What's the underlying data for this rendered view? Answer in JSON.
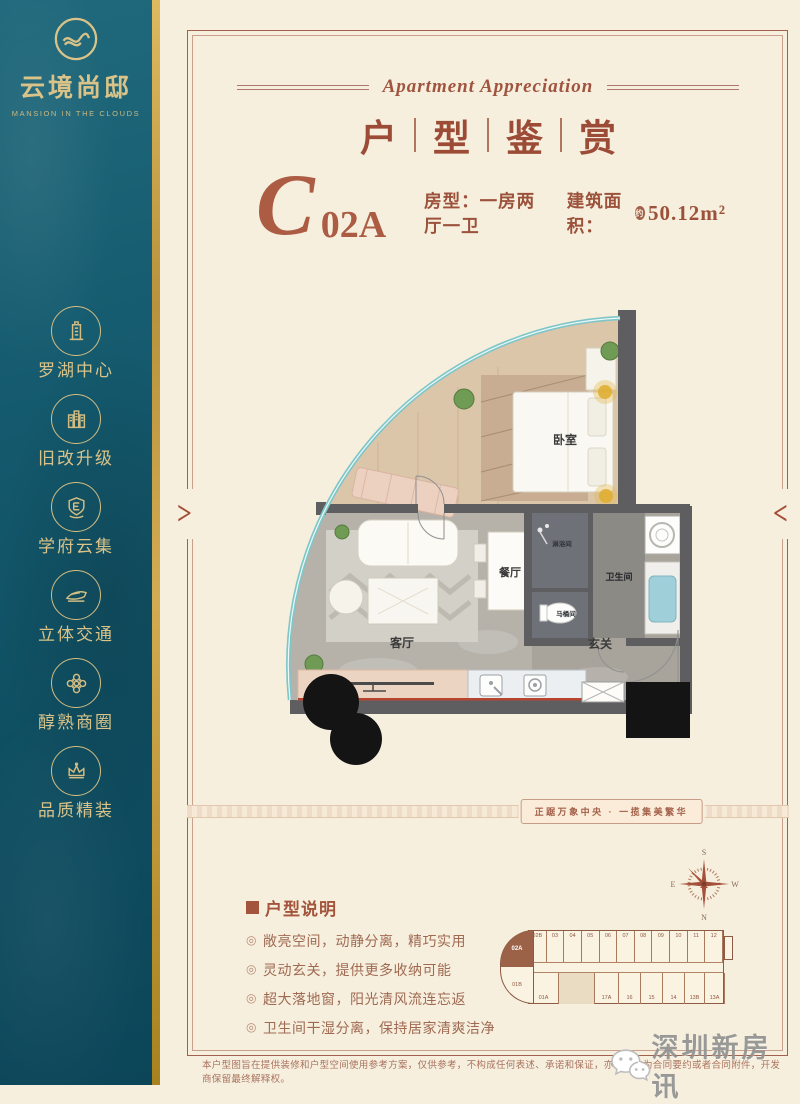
{
  "sidebar": {
    "logo": {
      "name": "云境尚邸",
      "subtitle": "MANSION IN THE CLOUDS"
    },
    "items": [
      {
        "icon": "tower-icon",
        "label": "罗湖中心"
      },
      {
        "icon": "buildings-icon",
        "label": "旧改升级"
      },
      {
        "icon": "shield-e-icon",
        "label": "学府云集"
      },
      {
        "icon": "train-icon",
        "label": "立体交通"
      },
      {
        "icon": "flower-icon",
        "label": "醇熟商圈"
      },
      {
        "icon": "crown-icon",
        "label": "品质精装"
      }
    ]
  },
  "header": {
    "script_title": "Apartment Appreciation",
    "title_chars": [
      "户",
      "型",
      "鉴",
      "赏"
    ]
  },
  "unit": {
    "letter": "C",
    "number": "02A",
    "layout_label": "房型：一房两厅一卫",
    "area_label": "建筑面积：",
    "area_approx": "约",
    "area_value": "50.12",
    "area_unit": "m²"
  },
  "plan": {
    "rooms": [
      {
        "label": "卧室"
      },
      {
        "label": "餐厅"
      },
      {
        "label": "客厅"
      },
      {
        "label": "玄关"
      },
      {
        "label": "淋浴间"
      },
      {
        "label": "马桶间"
      },
      {
        "label": "卫生间"
      }
    ]
  },
  "band": {
    "slogan": "正踞万象中央 · 一揽集美繁华"
  },
  "notes": {
    "title": "户型说明",
    "bullet": "◎",
    "items": [
      "敞亮空间，动静分离，精巧实用",
      "灵动玄关，提供更多收纳可能",
      "超大落地窗，阳光清风流连忘返",
      "卫生间干湿分离，保持居家清爽洁净"
    ]
  },
  "compass": {
    "top": "S",
    "left": "E",
    "right": "W",
    "bottom": "N"
  },
  "keyplan": {
    "highlight": "02A",
    "top": [
      "02B",
      "03",
      "04",
      "05",
      "06",
      "07",
      "08",
      "09",
      "10",
      "11",
      "12"
    ],
    "bottom_left": [
      "01B",
      "01A"
    ],
    "bottom_right": [
      "17A",
      "16",
      "15",
      "14",
      "13B",
      "13A"
    ]
  },
  "nav": {
    "left_arrow": ">",
    "right_arrow": "<"
  },
  "watermark": {
    "text": "深圳新房讯"
  },
  "footer": {
    "disclaimer": "本户型图旨在提供装修和户型空间使用参考方案，仅供参考，不构成任何表述、承诺和保证，亦不可作为合同要约或者合同附件，开发商保留最终解释权。"
  }
}
